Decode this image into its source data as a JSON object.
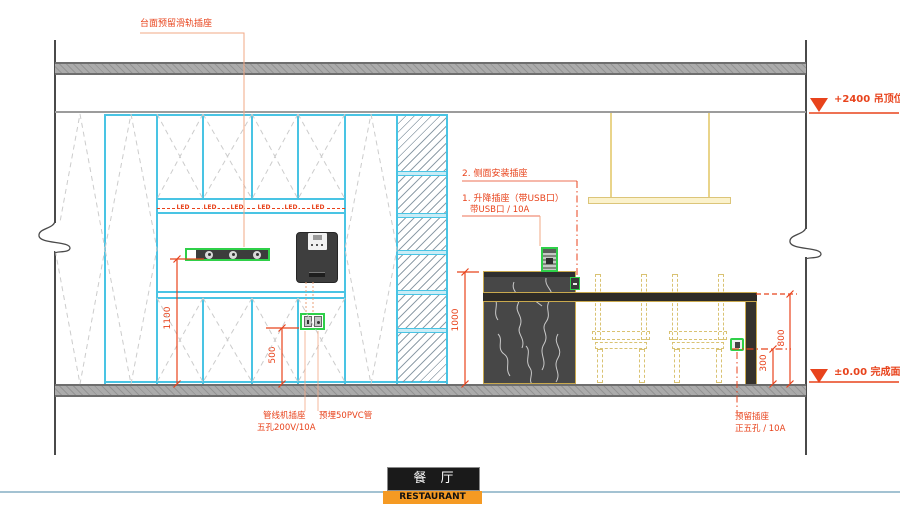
{
  "title_block": {
    "cn": "餐 厅",
    "en": "RESTAURANT"
  },
  "levels": {
    "ceiling": "+2400  吊顶位",
    "floor": "±0.00  完成面"
  },
  "dimensions": {
    "counter_height": "1100",
    "socket_height_left": "500",
    "island_height": "1000",
    "table_height": "800",
    "socket_height_right": "300"
  },
  "annotations": {
    "top": "台面预留滑轨插座",
    "side_socket": "2. 侧面安装插座",
    "lift_socket_line1": "1. 升降插座（带USB口）",
    "lift_socket_line2": "带USB口  /  10A",
    "pipeline_socket_line1": "管线机插座",
    "pipeline_socket_line2": "五孔200V/10A",
    "pvc_pipe": "预埋50PVC管",
    "reserved_socket_line1": "预留插座",
    "reserved_socket_line2": "正五孔  /  10A"
  },
  "led_labels": [
    "LED",
    "LED",
    "LED",
    "LED",
    "LED",
    "LED"
  ],
  "colors": {
    "cad_red": "#E8431C",
    "cabinet_cyan": "#49C4E4",
    "furniture_khaki": "#C9A94E",
    "socket_green": "#2FD049",
    "title_orange": "#F59A23",
    "marble_dark": "#474747"
  }
}
